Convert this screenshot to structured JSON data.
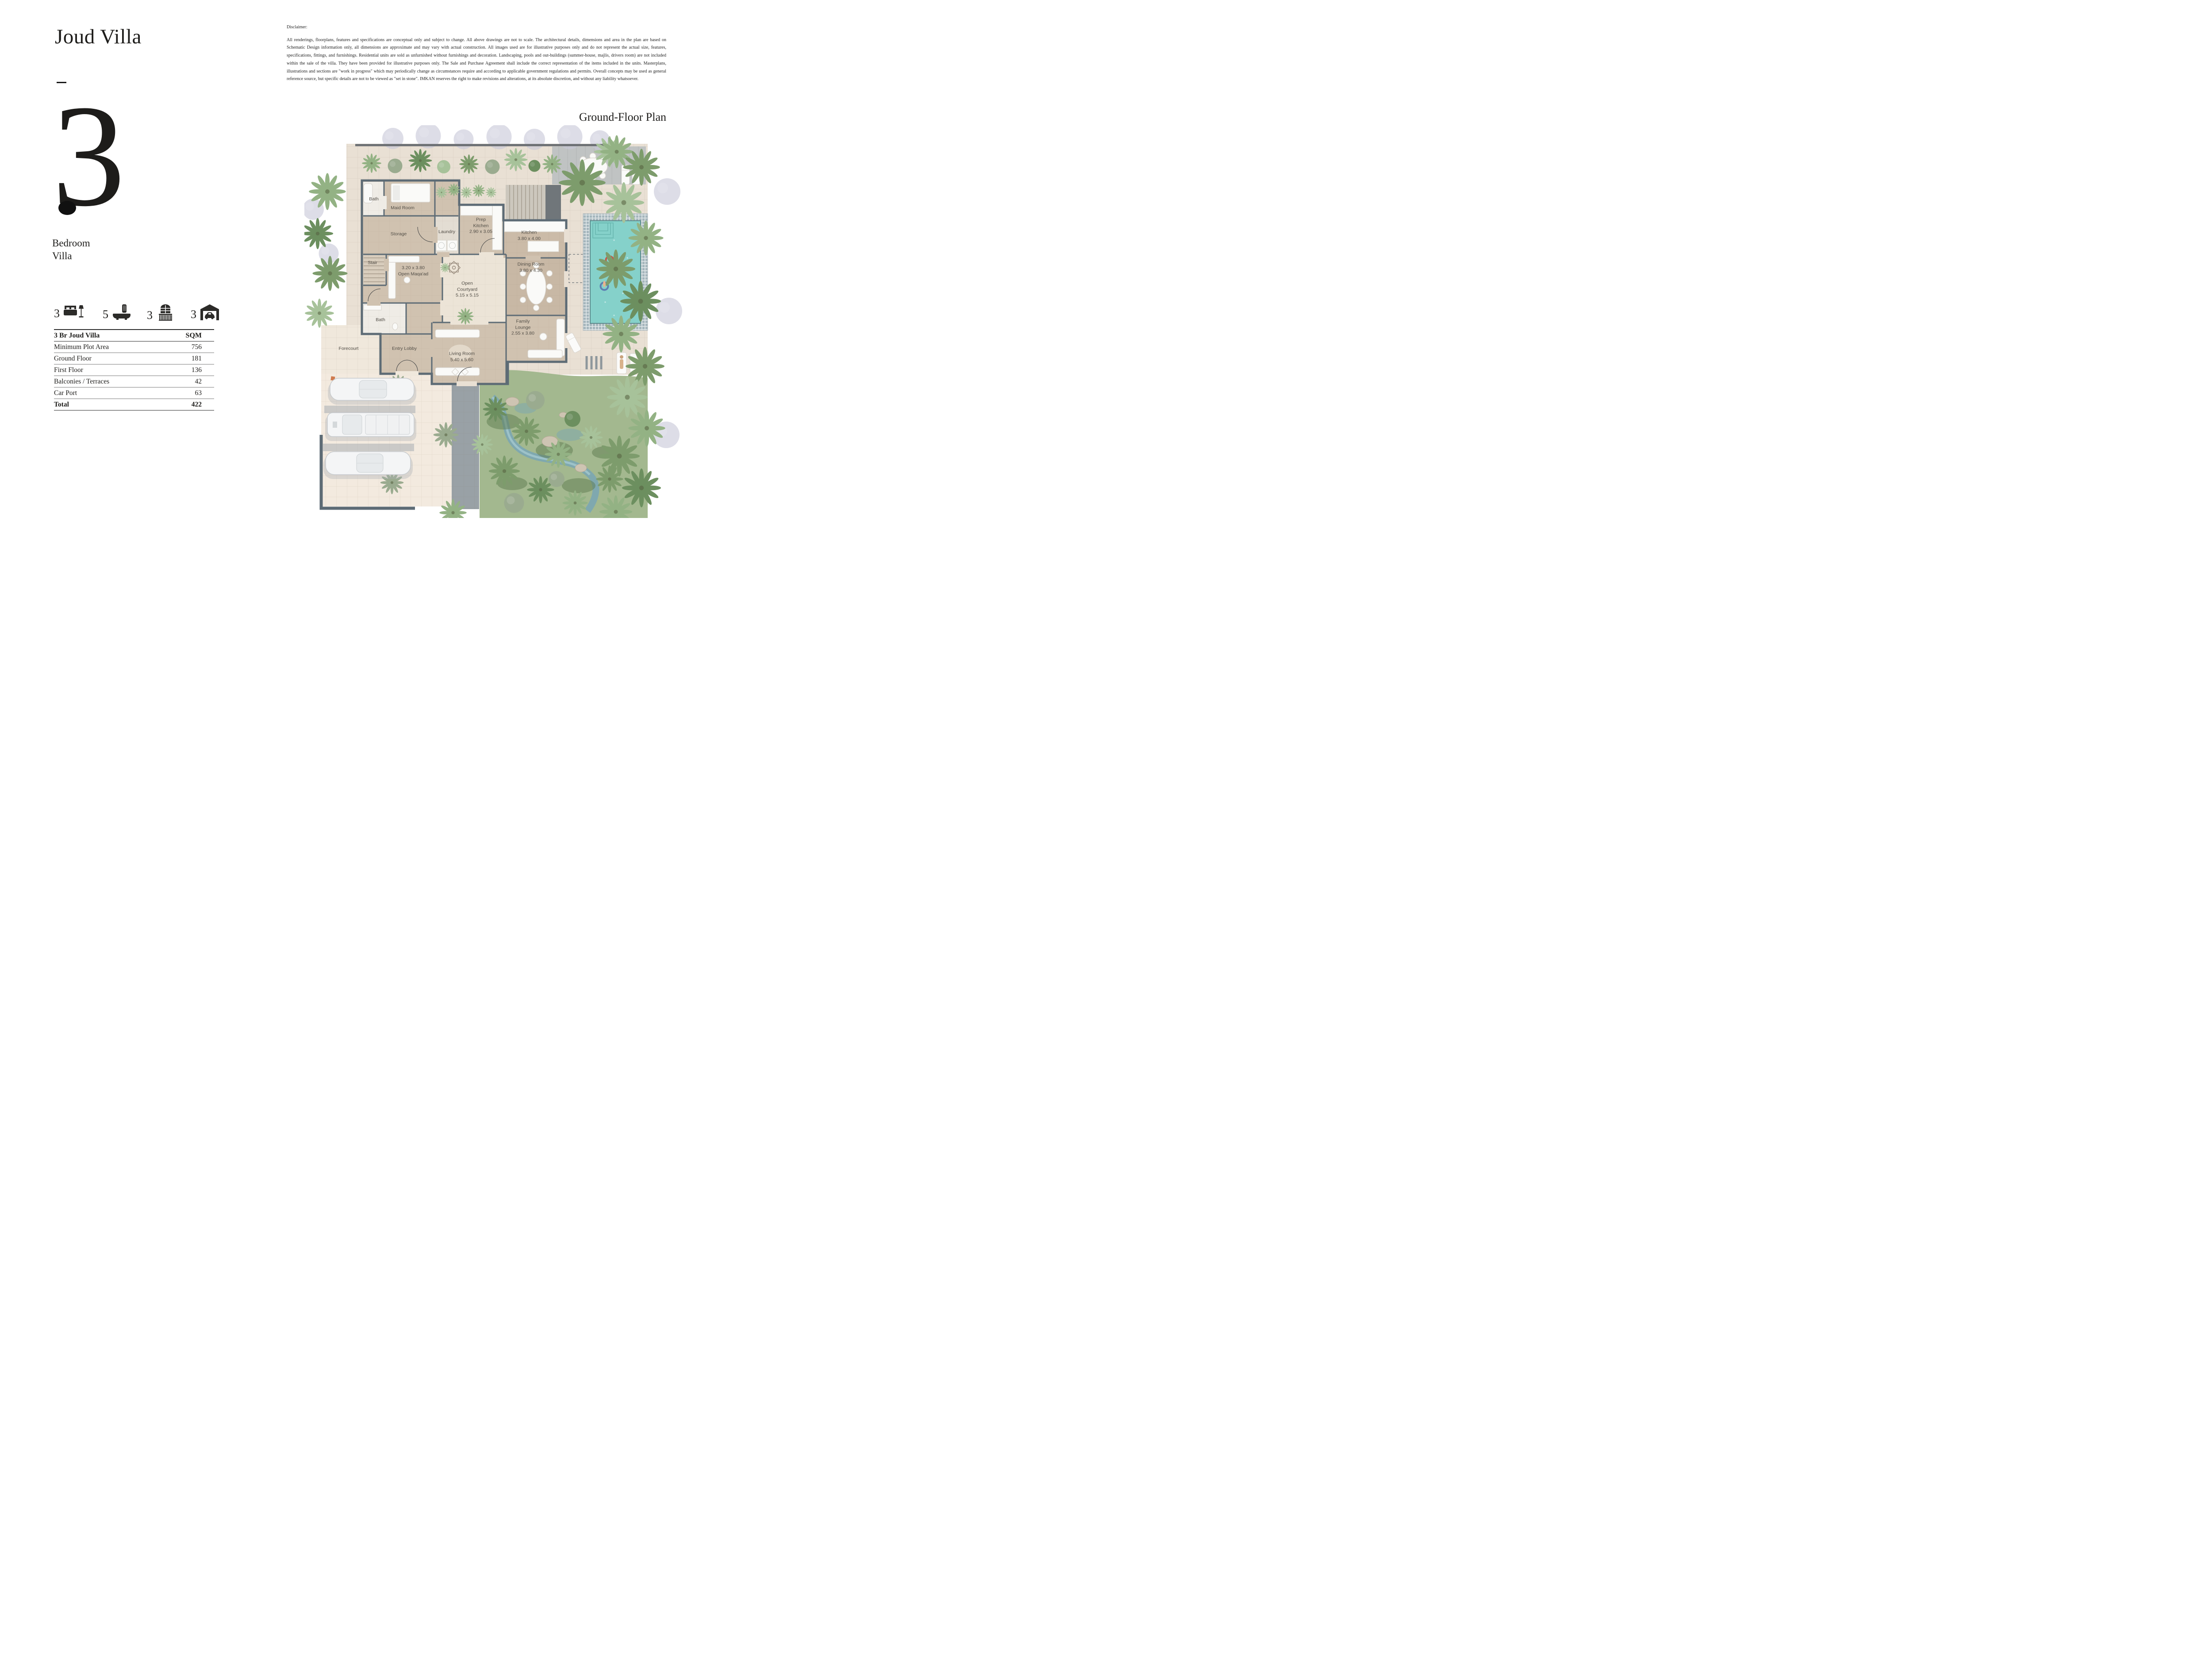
{
  "header": {
    "title": "Joud Villa"
  },
  "unit": {
    "number": "3",
    "line1": "Bedroom",
    "line2": "Villa"
  },
  "plan_heading": "Ground-Floor Plan",
  "disclaimer": {
    "heading": "Disclaimer:",
    "body": "All renderings, floorplans, features and specifications are conceptual only and subject to change. All above drawings are not to scale. The architectural details, dimensions and area in the plan are based on Schematic Design information only, all dimensions are approximate and may vary with actual construction. All images used are for illustrative purposes only and do not represent the actual size, features, specifications, fittings, and furnishings. Residential units are sold as unfurnished without furnishings and decoration. Landscaping, pools and out-buildings (summer-house, majlis, drivers room) are not included within the sale of the villa. They have been provided for illustrative purposes only. The Sale and Purchase Agreement shall include the correct representation of the items included in the units. Masterplans, illustrations and sections are \"work in progress\" which may periodically change as circumstances require and according to applicable government regulations and permits. Overall concepts may be used as general reference source, but specific details are not to be viewed as \"set in stone\". IMKAN reserves the right to make revisions and alterations, at its absolute discretion, and without any liability whatsoever."
  },
  "stats": [
    {
      "name": "bedrooms",
      "icon": "bed-icon",
      "value": "3"
    },
    {
      "name": "bathrooms",
      "icon": "bath-icon",
      "value": "5"
    },
    {
      "name": "balconies",
      "icon": "balcony-icon",
      "value": "3"
    },
    {
      "name": "car-ports",
      "icon": "carport-icon",
      "value": "3"
    }
  ],
  "area_table": {
    "title": "3 Br Joud Villa",
    "unit_label": "SQM",
    "rows": [
      {
        "label": "Minimum Plot Area",
        "value": "756"
      },
      {
        "label": "Ground Floor",
        "value": "181"
      },
      {
        "label": "First Floor",
        "value": "136"
      },
      {
        "label": "Balconies / Terraces",
        "value": "42"
      },
      {
        "label": "Car Port",
        "value": "63"
      }
    ],
    "total": {
      "label": "Total",
      "value": "422"
    }
  },
  "floor_plan": {
    "rooms": [
      {
        "id": "bath-1",
        "label": "Bath"
      },
      {
        "id": "maid-room",
        "label": "Maid Room"
      },
      {
        "id": "storage",
        "label": "Storage"
      },
      {
        "id": "laundry",
        "label": "Laundry"
      },
      {
        "id": "prep-kitchen",
        "label": "Prep Kitchen",
        "dims": "2.90 x 3.05"
      },
      {
        "id": "kitchen",
        "label": "Kitchen",
        "dims": "3.80 x 4.00"
      },
      {
        "id": "dining-room",
        "label": "Dining Room",
        "dims": "3.80 x 4.30"
      },
      {
        "id": "stair",
        "label": "Stair"
      },
      {
        "id": "open-maqaad",
        "label": "Open Maqa'ad",
        "dims": "3.20 x 3.80"
      },
      {
        "id": "open-courtyard",
        "label": "Open Courtyard",
        "dims": "5.15 x 5.15"
      },
      {
        "id": "family-lounge",
        "label": "Family Lounge",
        "dims": "2.55 x 3.80"
      },
      {
        "id": "bath-2",
        "label": "Bath"
      },
      {
        "id": "entry-lobby",
        "label": "Entry Lobby"
      },
      {
        "id": "living-room",
        "label": "Living Room",
        "dims": "5.40 x 5.60"
      },
      {
        "id": "forecourt",
        "label": "Forecourt"
      }
    ]
  },
  "colors": {
    "ink": "#1d1c1a",
    "label": "#524e47",
    "wall": "#5d6b75",
    "floor-beige": "#d0c2b0",
    "courtyard": "#ece4d7",
    "terrace": "#e9e0d4",
    "forecourt": "#f0e8dc",
    "path-gray": "#99a1a6",
    "garden": "#a3b88f",
    "pool-water": "#85d1ca",
    "pool-tile": "#95a9b0",
    "stream": "#7ba6b2"
  }
}
